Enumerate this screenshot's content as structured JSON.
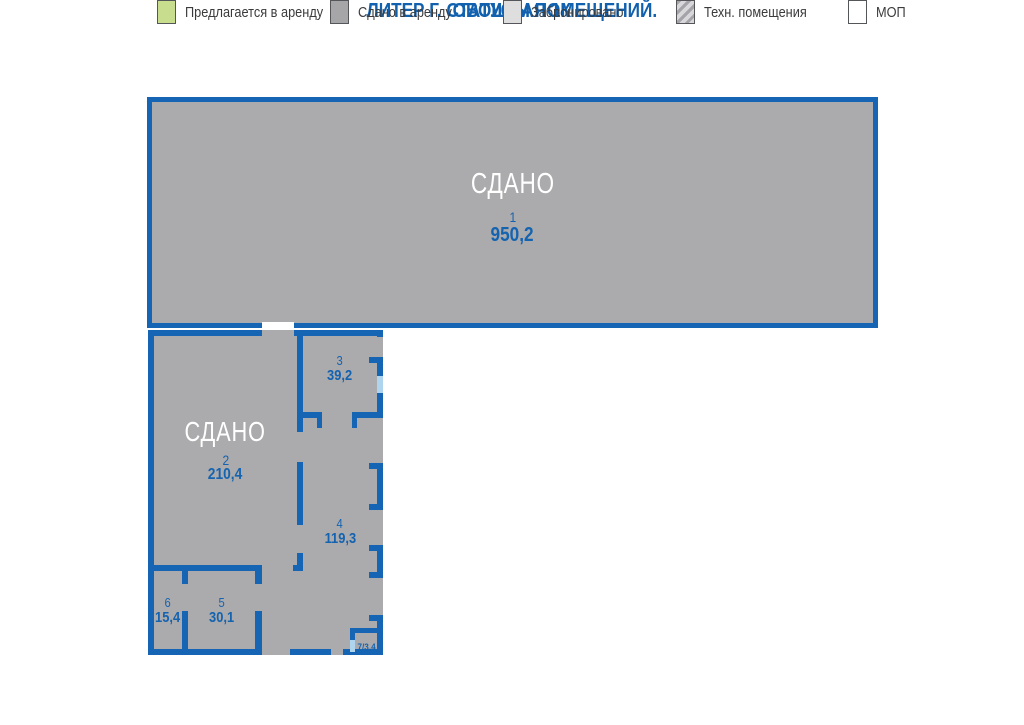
{
  "header": {
    "title": "ОВОЩНАЯ 1К",
    "subtitle": "ЛИТЕР Г. СТАТУСЫ ПОМЕЩЕНИЙ."
  },
  "rooms": {
    "r1": {
      "status": "СДАНО",
      "number": "1",
      "area": "950,2"
    },
    "r2": {
      "status": "СДАНО",
      "number": "2",
      "area": "210,4"
    },
    "r3": {
      "number": "3",
      "area": "39,2"
    },
    "r4": {
      "number": "4",
      "area": "119,3"
    },
    "r5": {
      "number": "5",
      "area": "30,1"
    },
    "r6": {
      "number": "6",
      "area": "15,4"
    },
    "r7": {
      "label": "7/3,4"
    }
  },
  "legend": {
    "items": [
      {
        "label": "Предлагается в аренду",
        "color": "#C9DD8F",
        "status": "offered"
      },
      {
        "label": "Сдано в аренду",
        "color": "#A6A6A8",
        "status": "rented"
      },
      {
        "label": "Забронировано",
        "color": "#DEDEDF",
        "status": "booked"
      },
      {
        "label": "Техн. помещения",
        "color": "#D8D8DA",
        "status": "technical",
        "pattern": "hatched"
      },
      {
        "label": "МОП",
        "color": "#FFFFFF",
        "status": "common-areas"
      }
    ]
  },
  "colors": {
    "wall": "#1565B4",
    "room_fill": "#ABAAAC",
    "window": "#AFD4EE",
    "title_text": "#1261AE",
    "room_text": "#1463B0",
    "legend_text": "#3B3B3D",
    "legend_border": "#54565A"
  }
}
